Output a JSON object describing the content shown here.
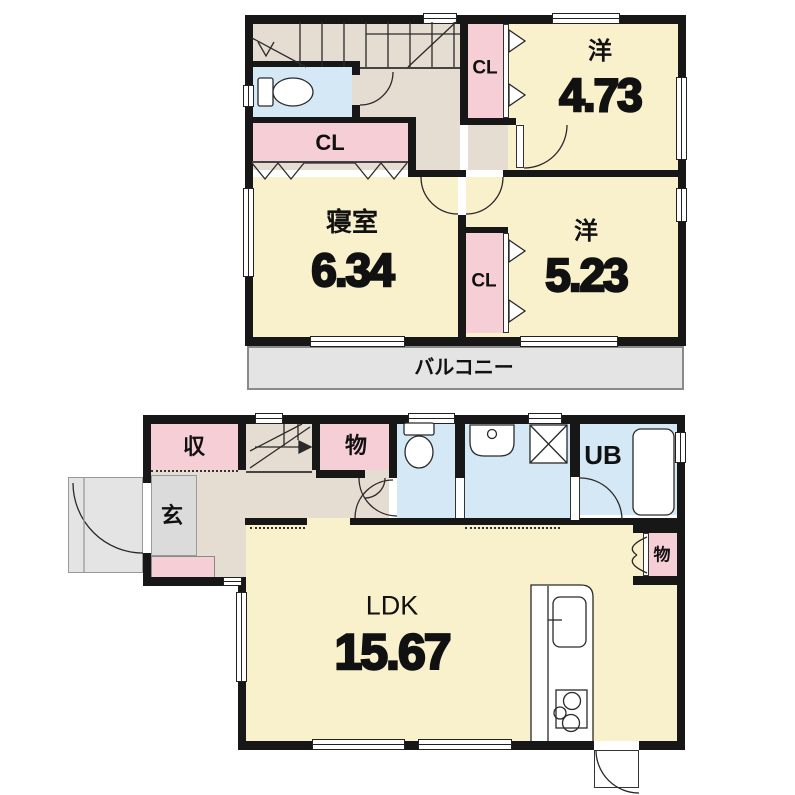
{
  "floor2": {
    "room_west1": {
      "label": "洋",
      "area": "4.73"
    },
    "bedroom": {
      "label": "寝室",
      "area": "6.34"
    },
    "room_west2": {
      "label": "洋",
      "area": "5.23"
    },
    "cl_upper": "CL",
    "cl_middle": "CL",
    "cl_lower": "CL",
    "balcony": "バルコニー"
  },
  "floor1": {
    "ldk": {
      "label": "LDK",
      "area": "15.67"
    },
    "entrance": "玄",
    "shoe_storage": "収",
    "hall_storage": "物",
    "ldk_storage": "物",
    "unit_bath": "UB"
  },
  "colors": {
    "room_yellow": "#f9f0cc",
    "closet_pink": "#f6ced6",
    "wet_blue": "#d4e8f5",
    "hall_tan": "#e5dcd2",
    "entrance_gray": "#dbdbdb",
    "balcony_gray": "#e4e4e4",
    "wall_black": "#171717"
  }
}
